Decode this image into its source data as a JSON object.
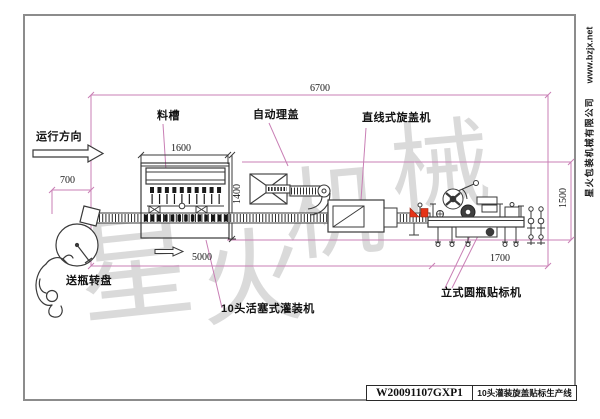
{
  "drawing": {
    "direction_label": "运行方向",
    "machine_labels": {
      "trough": "料槽",
      "cap_sorter": "自动理盖",
      "capper": "直线式旋盖机",
      "turntable": "送瓶转盘",
      "filler": "10头活塞式灌装机",
      "labeler": "立式圆瓶贴标机"
    },
    "dimensions": {
      "total_length": "6700",
      "infeed_offset": "700",
      "trough_width": "1600",
      "filler_depth": "1400",
      "filling_section": "5000",
      "labeling_section": "1700",
      "line_depth": "1500"
    }
  },
  "title_block": {
    "drawing_no": "W20091107GXP1",
    "drawing_title": "10头灌装旋盖贴标生产线"
  },
  "watermark": {
    "text": "星火机械",
    "chars": [
      "星",
      "火",
      "机",
      "械"
    ]
  },
  "margin_note": {
    "company": "星火包装机械有限公司",
    "website": "www.bzjx.net"
  },
  "colors": {
    "dimension_line": "#c97fb5",
    "drawing_line": "#3a3a3a",
    "accent_red": "#e63317",
    "border": "#8c8c8c",
    "watermark": "#8f8f8f"
  }
}
